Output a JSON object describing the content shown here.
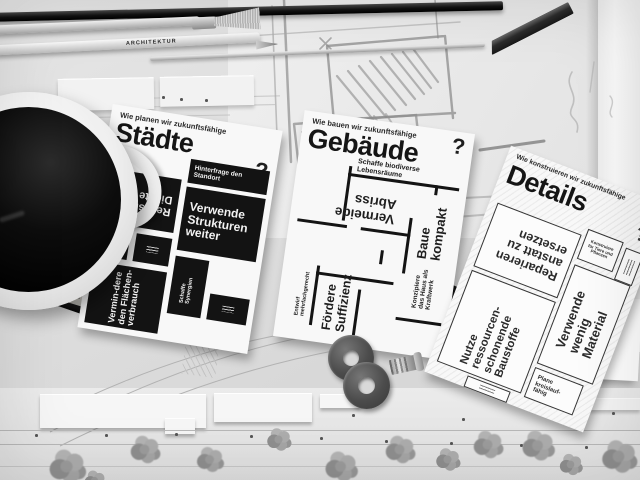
{
  "cards": [
    {
      "question": "Wie planen wir zukunftsfähige",
      "title": "Städte",
      "qmark": "?",
      "items": [
        "Realisiere Dichte",
        "Hinterfrage den Standort",
        "Verwende Strukturen weiter",
        "Vermin-dere den Flächen-verbrauch",
        "Schaffe Synergien"
      ]
    },
    {
      "question": "Wie bauen wir zukunftsfähige",
      "title": "Gebäude",
      "qmark": "?",
      "items": [
        "Schaffe biodiverse Lebensräume",
        "Baue kompakt",
        "Vermeide Abriss",
        "Entwirf mehrfachgerecht",
        "Fördere Suffizienz",
        "Konzipiere das Haus als Kraftwerk"
      ]
    },
    {
      "question": "Wie konstruieren wir zukunftsfähige",
      "title": "Details",
      "qmark": "?",
      "items": [
        "Reparieren anstatt zu ersetzen",
        "Konstruiere für Tiere und Pflanzen",
        "Verwende wenig Material",
        "Nutze ressourcen-schonende Baustoffe",
        "Plane kreislauf-fähig"
      ]
    }
  ],
  "objects": {
    "pencil_label": "ARCHITEKTUR",
    "ruler_marks": [
      "0",
      "41",
      "4"
    ]
  },
  "colors": {
    "ink": "#131313",
    "card": "#f8f8f8",
    "coffee": "#0d0d0d"
  }
}
